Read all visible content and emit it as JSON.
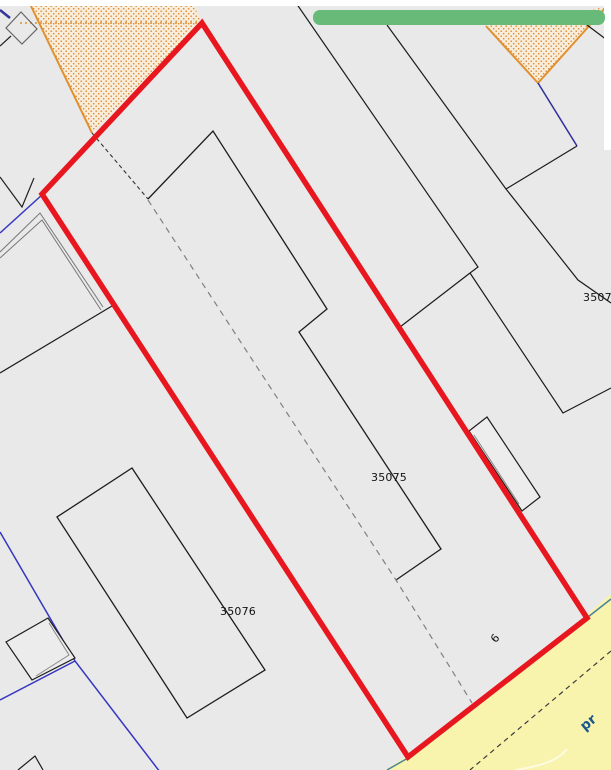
{
  "map": {
    "parcel_labels": {
      "p35075": "35075",
      "p35076": "35076",
      "p350_partial": "3507",
      "p6": "6"
    },
    "road_label": "pr",
    "colors": {
      "parcel_highlight_red": "#e8171f",
      "toast_green": "#68ba78",
      "road_yellow": "#f8f4ad",
      "boundary_blue": "#3636c2",
      "zone_orange_dots": "#dd8a33",
      "zone_orange_line": "#e0902f",
      "base_gray": "#e9e9e9"
    }
  }
}
